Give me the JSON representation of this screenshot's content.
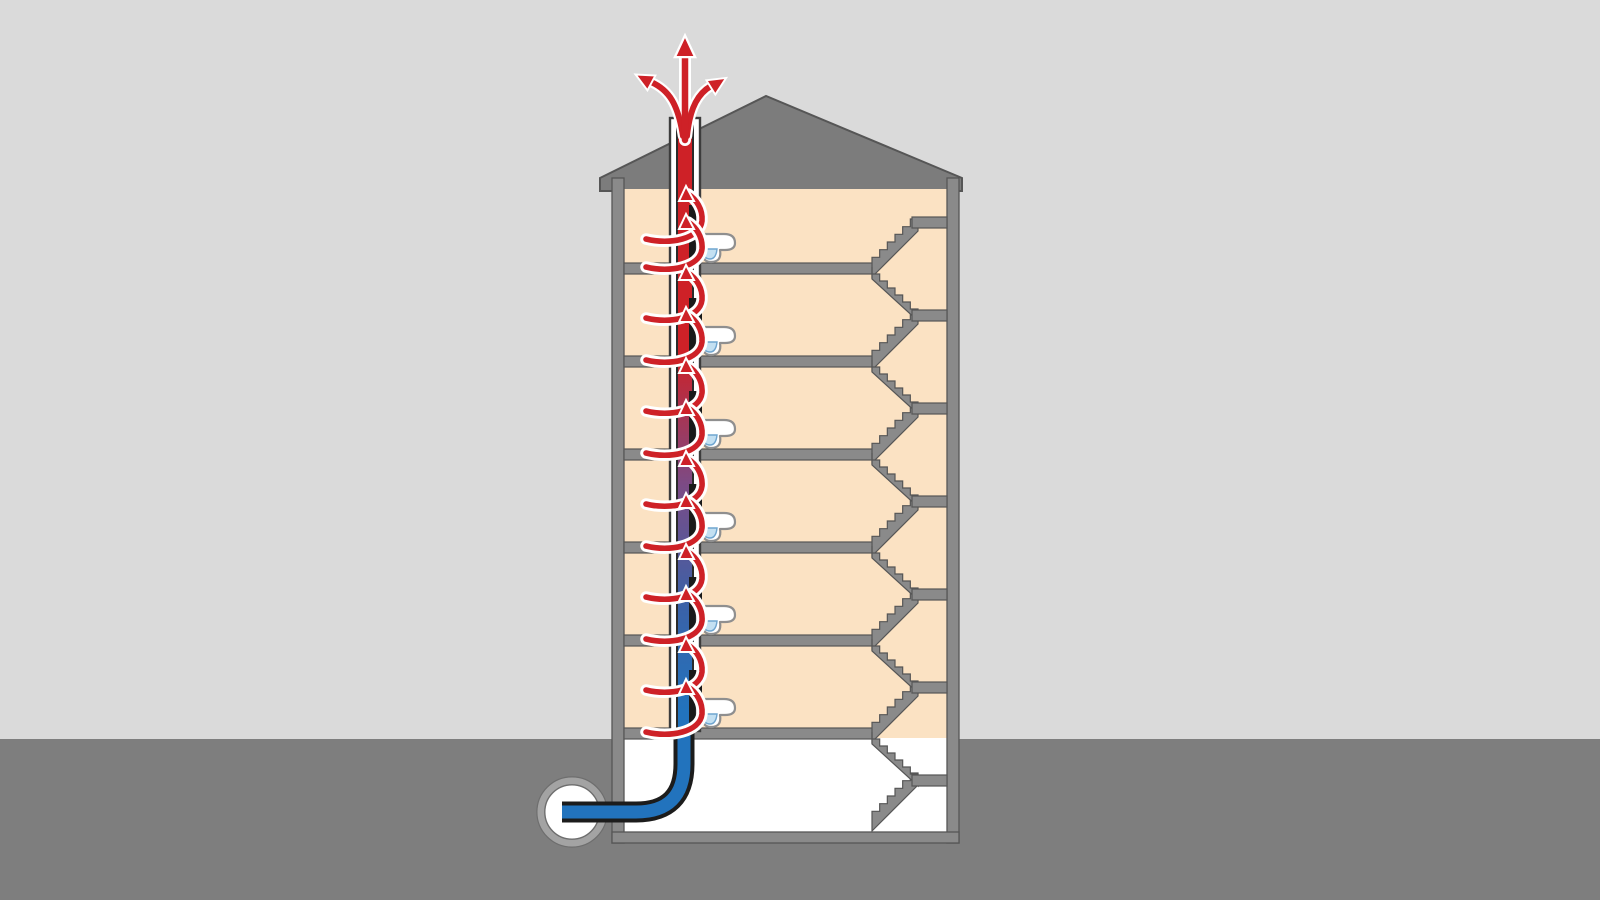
{
  "scene": {
    "type": "cutaway-technical-illustration",
    "subject": "Multi-storey building cross-section showing toilets connected to a sewer ventilation stack that vents foul air above the roof",
    "floor_count": 6,
    "has_basement": true,
    "toilet_count": 6,
    "airflow_arrows_per_floor": 2,
    "roof_exit_arrow_count": 3,
    "stair_flight_count": 13,
    "stair_landing_count": 7,
    "manhole_count": 1
  },
  "colors": {
    "sky": "#DADADA",
    "ground": "#7E7E7E",
    "roof": "#7C7C7C",
    "structure": "#8A8A8A",
    "structure_edge": "#565656",
    "room": "#FBE2C3",
    "basement": "#FFFFFF",
    "stack_casing": "#FFFFFF",
    "stack_wall": "#3C3C3C",
    "flow_red": "#CE2127",
    "flow_purple": "#7B4B86",
    "pipe_blue": "#2273BD",
    "pipe_outline": "#1C1C1C",
    "carrier_black": "#1A1A1A",
    "toilet_white": "#FFFFFF",
    "toilet_outline": "#8F8F8F",
    "water_blue": "#C3E0F2",
    "water_outline": "#6FA5CF",
    "manhole_ring": "#A3A3A3",
    "arrow_casing": "#FFFFFF"
  }
}
